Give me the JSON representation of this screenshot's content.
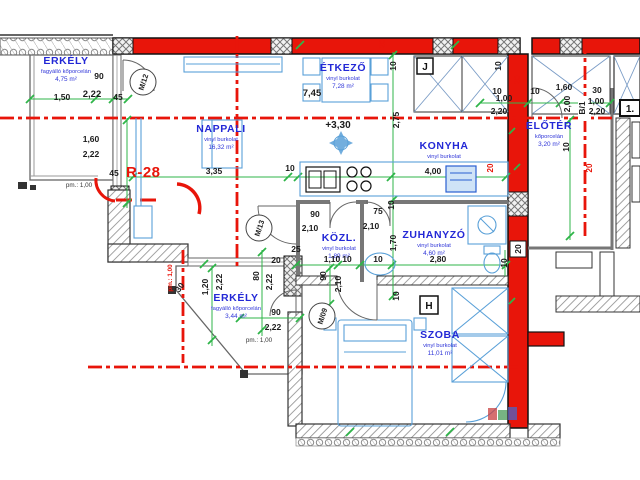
{
  "plan": {
    "flat_code": "R-28",
    "level_mark": "+3,30",
    "rooms": [
      {
        "name": "ERKÉLY",
        "finish": "fagyálló kőporcelán",
        "area": "4,75 m²"
      },
      {
        "name": "NAPPALI",
        "finish": "vinyl burkolat",
        "area": "16,32 m²"
      },
      {
        "name": "ÉTKEZŐ",
        "finish": "vinyl burkolat",
        "area": "7,28 m²"
      },
      {
        "name": "KONYHA",
        "finish": "vinyl burkolat",
        "area": "4,94 m²"
      },
      {
        "name": "ELŐTÉR",
        "finish": "kőporcelán",
        "area": "3,20 m²"
      },
      {
        "name": "KÖZL.",
        "finish": "vinyl burkolat",
        "area": "1,89 m²"
      },
      {
        "name": "ZUHANYZÓ",
        "finish": "vinyl burkolat",
        "area": "4,60 m²"
      },
      {
        "name": "ERKÉLY",
        "finish": "fagyálló kőporcelán",
        "area": "3,44 m²"
      },
      {
        "name": "SZOBA",
        "finish": "vinyl burkolat",
        "area": "11,01 m²"
      }
    ],
    "door_tags": [
      "M/12",
      "M/13",
      "M/09"
    ],
    "tags": {
      "j": "J",
      "h": "H",
      "one": "1.",
      "axis": "B/1",
      "wall20": "20"
    },
    "dims_h": [
      "90",
      "1,50",
      "2,22",
      "45",
      "1,60",
      "2,22",
      "45",
      "pm.: 1,00",
      "3,35",
      "10",
      "7,45",
      "4,00",
      "10",
      "10",
      "1,60",
      "30",
      "1,00",
      "1,00",
      "2,20",
      "2,20",
      "90",
      "2,10",
      "75",
      "2,10",
      "1,10",
      "10",
      "10",
      "2,80",
      "25",
      "20",
      "90",
      "2,22",
      "pm.: 1,00"
    ],
    "dims_v": [
      "10",
      "2,75",
      "10",
      "2,00",
      "10",
      "1,70",
      "10",
      "90",
      "2,10",
      "10",
      "80",
      "2,22",
      "1,20",
      "2,22",
      "30",
      "10"
    ],
    "red_dims": [
      "20",
      "20",
      "20",
      "20",
      "pm.: 1,00"
    ],
    "colors": {
      "wall_red": "#e8150a",
      "label_blue": "#2328d6",
      "dim_green": "#2fb549",
      "furniture_blue": "#59a0d8"
    }
  }
}
